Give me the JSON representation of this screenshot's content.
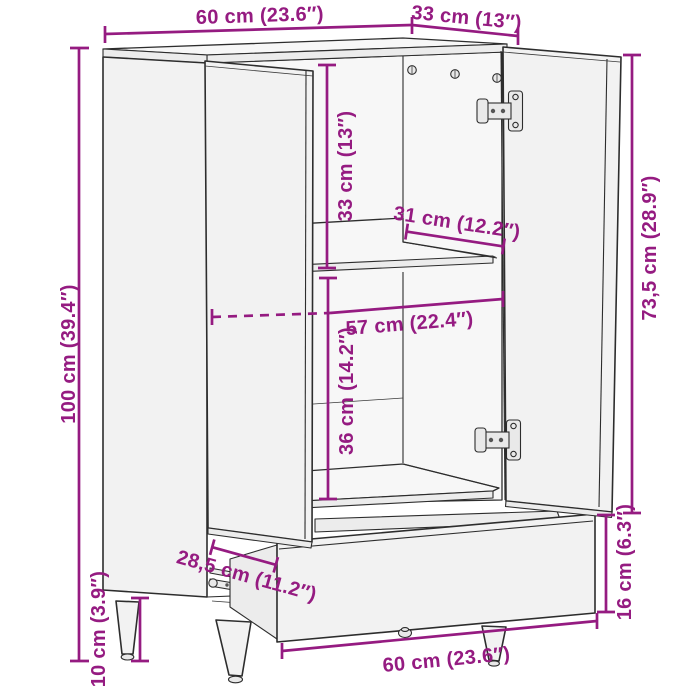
{
  "figure": {
    "type": "furniture-dimension-diagram",
    "subject": "highboard cabinet with two open doors and pulled-out drawer",
    "colors": {
      "dimension_accent": "#951B81",
      "line_art": "#2D2D2D",
      "panel_fill": "#F2F2F2",
      "background": "#FFFFFF"
    }
  },
  "dimensions": {
    "top_width": "60 cm (23.6″)",
    "top_depth": "33 cm (13″)",
    "overall_height": "100 cm (39.4″)",
    "upper_compartment_height": "33 cm (13″)",
    "shelf_depth": "31 cm (12.2″)",
    "interior_width": "57 cm (22.4″)",
    "lower_compartment_height": "36 cm (14.2″)",
    "door_height": "73,5 cm (28.9″)",
    "drawer_front_height": "16 cm (6.3″)",
    "drawer_slide_depth": "28,5 cm (11.2″)",
    "bottom_width": "60 cm (23.6″)",
    "leg_height": "10 cm (3.9″)"
  }
}
